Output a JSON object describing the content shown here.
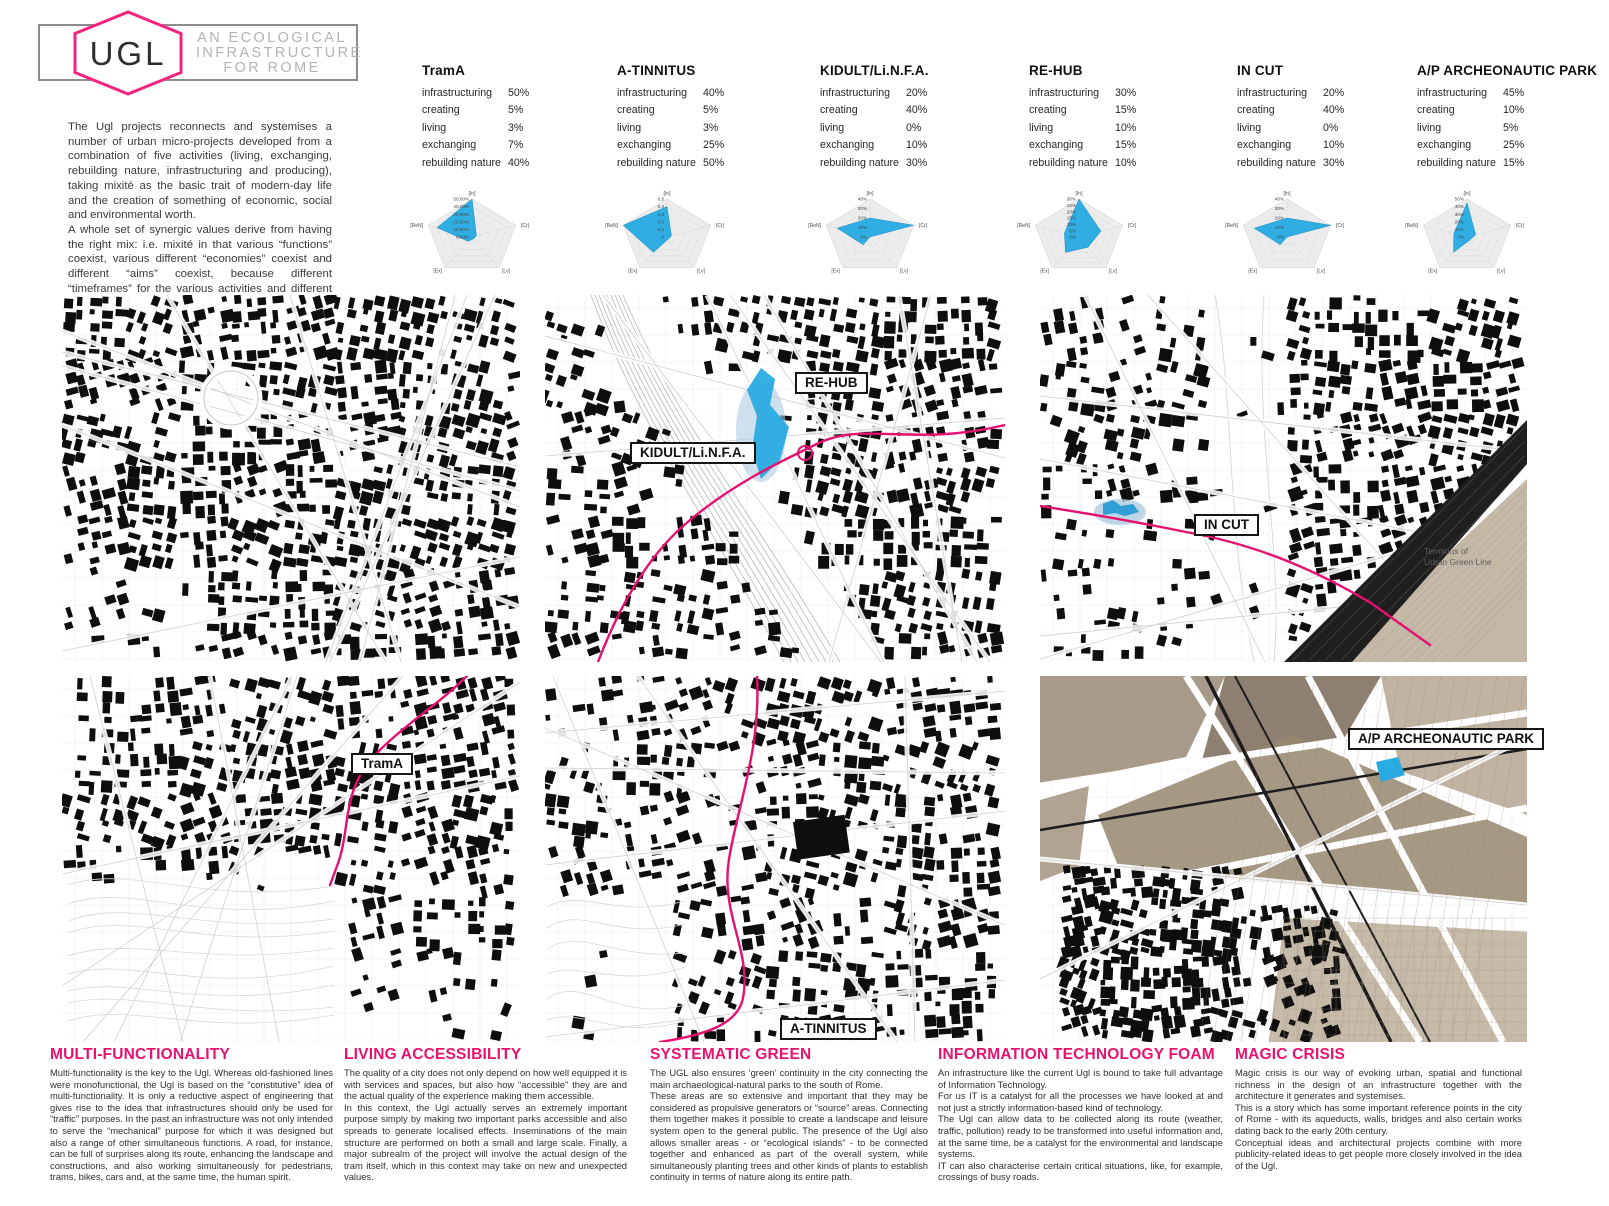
{
  "colors": {
    "accent": "#E5106F",
    "radar_blue": "#29ABE2",
    "map_blue_light": "#AFCBE2",
    "parchment": "#A2927F"
  },
  "header": {
    "logo_text": "UGL",
    "tagline_lines": [
      "AN ECOLOGICAL",
      "INFRASTRUCTURE",
      "FOR ROME"
    ]
  },
  "intro": "The Ugl projects reconnects and systemises a number of urban micro-projects developed from a combination of five activities (living, exchanging, rebuilding nature, infrastructuring and producing), taking mixité as the basic trait of modern-day life and the creation of something of economic, social and environmental worth.\nA whole set of synergic values derive from having the right mix: i.e. mixité in that various “functions” coexist, various different “economies” coexist and different “aims” coexist, because different “timeframes” for the various activities and different “spaces” for activities being carried out simultaneously also coexist: often in the same physical space.",
  "metric_labels": [
    "infrastructuring",
    "creating",
    "living",
    "exchanging",
    "rebuilding nature"
  ],
  "projects": [
    {
      "name": "TramA",
      "values": [
        "50%",
        "5%",
        "3%",
        "7%",
        "40%"
      ]
    },
    {
      "name": "A-TINNITUS",
      "values": [
        "40%",
        "5%",
        "3%",
        "25%",
        "50%"
      ]
    },
    {
      "name": "KIDULT/Li.N.F.A.",
      "values": [
        "20%",
        "40%",
        "0%",
        "10%",
        "30%"
      ]
    },
    {
      "name": "RE-HUB",
      "values": [
        "30%",
        "15%",
        "10%",
        "15%",
        "10%"
      ]
    },
    {
      "name": "IN CUT",
      "values": [
        "20%",
        "40%",
        "0%",
        "10%",
        "30%"
      ]
    },
    {
      "name": "A/P ARCHEONAUTIC PARK",
      "values": [
        "45%",
        "10%",
        "5%",
        "25%",
        "15%"
      ]
    }
  ],
  "chart_data": [
    {
      "type": "radar",
      "project": "TramA",
      "axes": [
        "[In]",
        "[Cr]",
        "[Lv]",
        "[Ex]",
        "[ReN]"
      ],
      "values_pct": [
        50,
        5,
        3,
        7,
        40
      ],
      "max_pct": 50,
      "tick_labels": [
        "50,00%",
        "40,00%",
        "30,00%",
        "20,00%",
        "10,00%",
        "0,00%"
      ]
    },
    {
      "type": "radar",
      "project": "A-TINNITUS",
      "axes": [
        "[In]",
        "[Cr]",
        "[Lv]",
        "[Ex]",
        "[ReN]"
      ],
      "values_pct": [
        40,
        5,
        3,
        25,
        50
      ],
      "max_pct": 50,
      "tick_labels": [
        "0,5",
        "0,4",
        "0,3",
        "0,2",
        "0,1",
        "0"
      ]
    },
    {
      "type": "radar",
      "project": "KIDULT/Li.N.F.A.",
      "axes": [
        "[In]",
        "[Cr]",
        "[Lv]",
        "[Ex]",
        "[ReN]"
      ],
      "values_pct": [
        20,
        40,
        0,
        10,
        30
      ],
      "max_pct": 40,
      "tick_labels": [
        "40%",
        "30%",
        "20%",
        "10%",
        "0%"
      ]
    },
    {
      "type": "radar",
      "project": "RE-HUB",
      "axes": [
        "[In]",
        "[Cr]",
        "[Lv]",
        "[Ex]",
        "[ReN]"
      ],
      "values_pct": [
        30,
        15,
        10,
        15,
        10
      ],
      "max_pct": 30,
      "tick_labels": [
        "30%",
        "25%",
        "20%",
        "15%",
        "10%",
        "5%",
        "0%"
      ]
    },
    {
      "type": "radar",
      "project": "IN CUT",
      "axes": [
        "[In]",
        "[Cr]",
        "[Lv]",
        "[Ex]",
        "[ReN]"
      ],
      "values_pct": [
        20,
        40,
        0,
        10,
        30
      ],
      "max_pct": 40,
      "tick_labels": [
        "40%",
        "30%",
        "20%",
        "10%",
        "0%"
      ]
    },
    {
      "type": "radar",
      "project": "A/P ARCHEONAUTIC PARK",
      "axes": [
        "[In]",
        "[Cr]",
        "[Lv]",
        "[Ex]",
        "[ReN]"
      ],
      "values_pct": [
        45,
        10,
        5,
        25,
        15
      ],
      "max_pct": 50,
      "tick_labels": [
        "50%",
        "40%",
        "30%",
        "20%",
        "10%",
        "0%"
      ]
    }
  ],
  "maps": {
    "labels": {
      "rehub": "RE-HUB",
      "kidult": "KIDULT/Li.N.F.A.",
      "incut": "IN CUT",
      "note": "Terminus of\nUrban Green Line",
      "trama": "TramA",
      "atinnitus": "A-TINNITUS",
      "ap": "A/P ARCHEONAUTIC PARK"
    }
  },
  "sections": [
    {
      "title": "MULTI-FUNCTIONALITY",
      "body": "Multi-functionality is the key to the Ugl. Whereas old-fashioned lines were monofunctional, the Ugl is based on the “constitutive” idea of multi-functionality. It is only a reductive aspect of engineering that gives rise to the idea that infrastructures should only be used for “traffic”  purposes. In the past an infrastructure was not only intended to serve the “mechanical” purpose for which it was designed but also a range of other simultaneous functions. A road, for instance, can be full of surprises along its route, enhancing the landscape and constructions, and also working simultaneously for pedestrians, trams, bikes, cars and, at the same time, the human spirit."
    },
    {
      "title": "LIVING ACCESSIBILITY",
      "body": "The quality of a city does not only depend on how well equipped it is with services and spaces, but also how “accessible” they are and the actual quality of the experience making them accessible.\nIn this context, the Ugl actually serves an extremely important purpose simply by making two important parks accessible and also spreads to generate localised effects. Inseminations of the main structure are performed on both a small and large scale. Finally, a major subrealm of the project will involve the actual design of the tram itself, which in this context may take on new and unexpected values."
    },
    {
      "title": "SYSTEMATIC GREEN",
      "body": "The UGL also ensures ‘green’ continuity in the city connecting the main archaeological-natural parks to the south of Rome.\nThese areas are so extensive and important that they may be considered as propulsive generators or “source” areas. Connecting them together makes it possible to create a landscape and leisure system open to the general public. The presence of the Ugl also allows smaller areas - or “ecological islands” - to be connected together and enhanced as part of the overall system, while simultaneously planting trees and other kinds of plants to establish continuity in terms of nature along its entire path."
    },
    {
      "title": "INFORMATION TECHNOLOGY FOAM",
      "body": "An infrastructure like the current Ugl is bound to take full advantage of Information Technology.\nFor us IT is a catalyst for all the processes we have looked at and not just a strictly information-based kind of technology.\nThe Ugl can allow data to be collected along its route (weather, traffic, pollution) ready to be transformed into useful information and, at the same time, be a catalyst for the environmental and landscape systems.\nIT can also characterise certain critical situations, like, for example, crossings of busy roads."
    },
    {
      "title": "MAGIC CRISIS",
      "body": "Magic crisis is our way of evoking urban, spatial and functional richness in the design of an infrastructure together with the architecture it generates and systemises.\nThis is a story which has some important reference points in the city of Rome - with its aqueducts, walls, bridges and also certain works dating back to the early 20th century.\nConceptual ideas and architectural projects combine with more publicity-related ideas to get people more closely involved in the idea of the Ugl."
    }
  ]
}
